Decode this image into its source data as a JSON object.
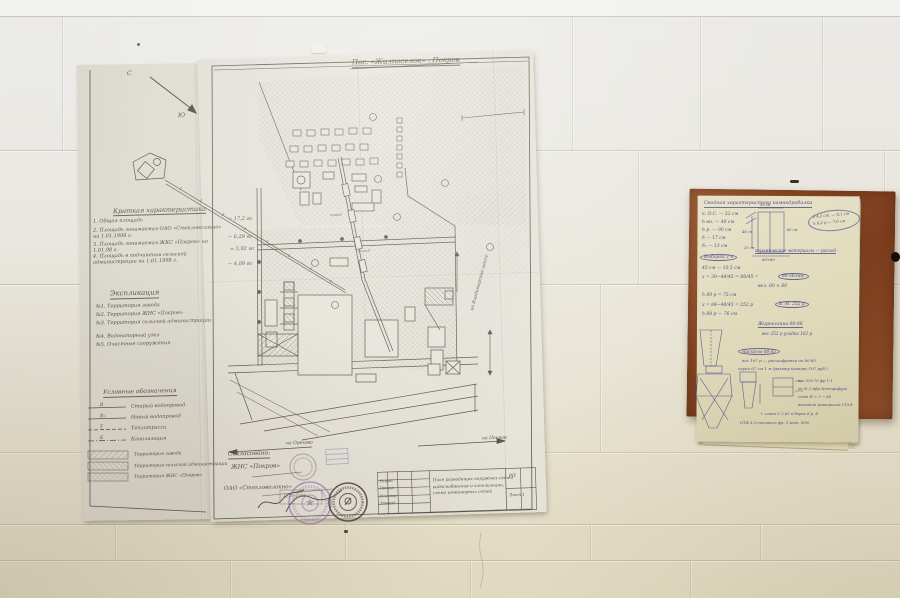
{
  "scene": {
    "description": "Photograph: folded hand-drawn site plan pinned to a white painted brick wall, with a handwritten calculation notebook on a hardboard panel to the right"
  },
  "colors": {
    "wall_top": "#ebebe9",
    "wall_bottom": "#e4ddc2",
    "paper_main": "#e6e3da",
    "paper_flap": "#dedbd1",
    "notebook_page": "#e0dabb",
    "board_brown": "#8a4a26",
    "drawing_ink": "#554f44",
    "notebook_ink": "#36387e",
    "stamp_purple": "#8a6aa8",
    "stamp_dark": "#454039"
  },
  "blueprint": {
    "title": "Пос. «Жилпоселок» : Покров",
    "compass": {
      "north": "С",
      "south": "Ю"
    },
    "brief": {
      "heading": "Краткая характеристика",
      "items": [
        {
          "label": "1. Общая площадь",
          "value": "− 17,2 га"
        },
        {
          "label": "2. Площадь занимаемая ОАО «Стекловолокно» на 1.01.1998 г.",
          "value": "− 6,29 га"
        },
        {
          "label": "3. Площадь занимаемая ЖКС «Покров» на 1.01.98 г.",
          "value": "= 5,92 га"
        },
        {
          "label": "4. Площадь в подчинении сельской администрации на 1.01.1998 г.",
          "value": "− 4,09 га"
        }
      ]
    },
    "explication": {
      "heading": "Экспликация",
      "items": [
        "№1. Территория завода",
        "№2. Территория ЖНС «Покров»",
        "№3. Территория сельской администрации",
        "№4. Водонапорный узел",
        "№5. Очистные сооружения"
      ]
    },
    "legend": {
      "heading": "Условные обозначения",
      "line_items": [
        {
          "key": "В",
          "label": "Старый водопровод"
        },
        {
          "key": "В₁",
          "label": "Новый водопровод"
        },
        {
          "key": "Т",
          "label": "Теплотрасса"
        },
        {
          "key": "К",
          "label": "Канализация"
        }
      ],
      "area_items": [
        "Территория завода",
        "Территория сельской администрации",
        "Территория ЖНС «Покров»"
      ]
    },
    "approvals": {
      "heading": "Согласовано:",
      "party1": "ЖНС «Покров»",
      "party2": "ОАО «Стекловолокно»",
      "date": "12.05.1998"
    },
    "map_labels": {
      "left_road": "на Орехово",
      "right_road": "на Покров",
      "right_edge": "на Владимирское шоссе",
      "area1": "завод",
      "area2": "склад"
    },
    "title_block": {
      "roles": [
        "Разраб.",
        "Провер.",
        "Н.контр.",
        "Утверд."
      ],
      "description": [
        "План разводящих наружных сетей",
        "водоснабжения и канализации,",
        "схема инженерных сетей"
      ],
      "stage": "РП",
      "sheet": "Лист 1"
    }
  },
  "notebook": {
    "heading": "Сводная характеристика камнедробилки",
    "side_note_1": "h 4,2 ст. — 8,1 см",
    "side_note_2": "h 8,2 р — 7,6 см",
    "col1": [
      "к. О.С. — 52 см",
      "h вн. — 48 см",
      "h р. — 90 см",
      "δ — 17 см",
      "δ₁ — 13 см"
    ],
    "mid": [
      {
        "text": "Выборка 2-я"
      },
      {
        "text": "45 см — 10,5 см"
      },
      {
        "text": "x = 30−48/45 = 88/45 ="
      },
      {
        "text": "88 облиц."
      },
      {
        "text": "вел. 60 × 60"
      },
      {
        "text": "h 80 р = 75 см"
      },
      {
        "text": "x = 84−48/45 = 252 р"
      },
      {
        "text": "Б. И. 252 р"
      },
      {
        "text": "h 88 р — 76 см"
      }
    ],
    "center_note": "керамические материалы — расход",
    "right": [
      "Жирноглина 80-88",
      "вес 252 р усадка 162 р",
      "Насыпью 80-85",
      "вес 107 р — расшифровка до 80-85",
      "через 67 см 1 м (размер камеры 107 руб.)"
    ],
    "bottom": [
      "вес 50×70 фр 1:1",
      "до № 2 вфр Центрифуга",
      "счёт Ф = 2 − 80",
      "выходит материала 119,8",
      "+ глина С 2,82 в барке 6 р. 8",
      "ОТФ 3,3 типового фр. 5 мат. 30%"
    ],
    "sketch_labels": {
      "a": "50 см",
      "b": "85 см",
      "c": "48 см",
      "d": "20 см",
      "e": "60×60"
    }
  }
}
